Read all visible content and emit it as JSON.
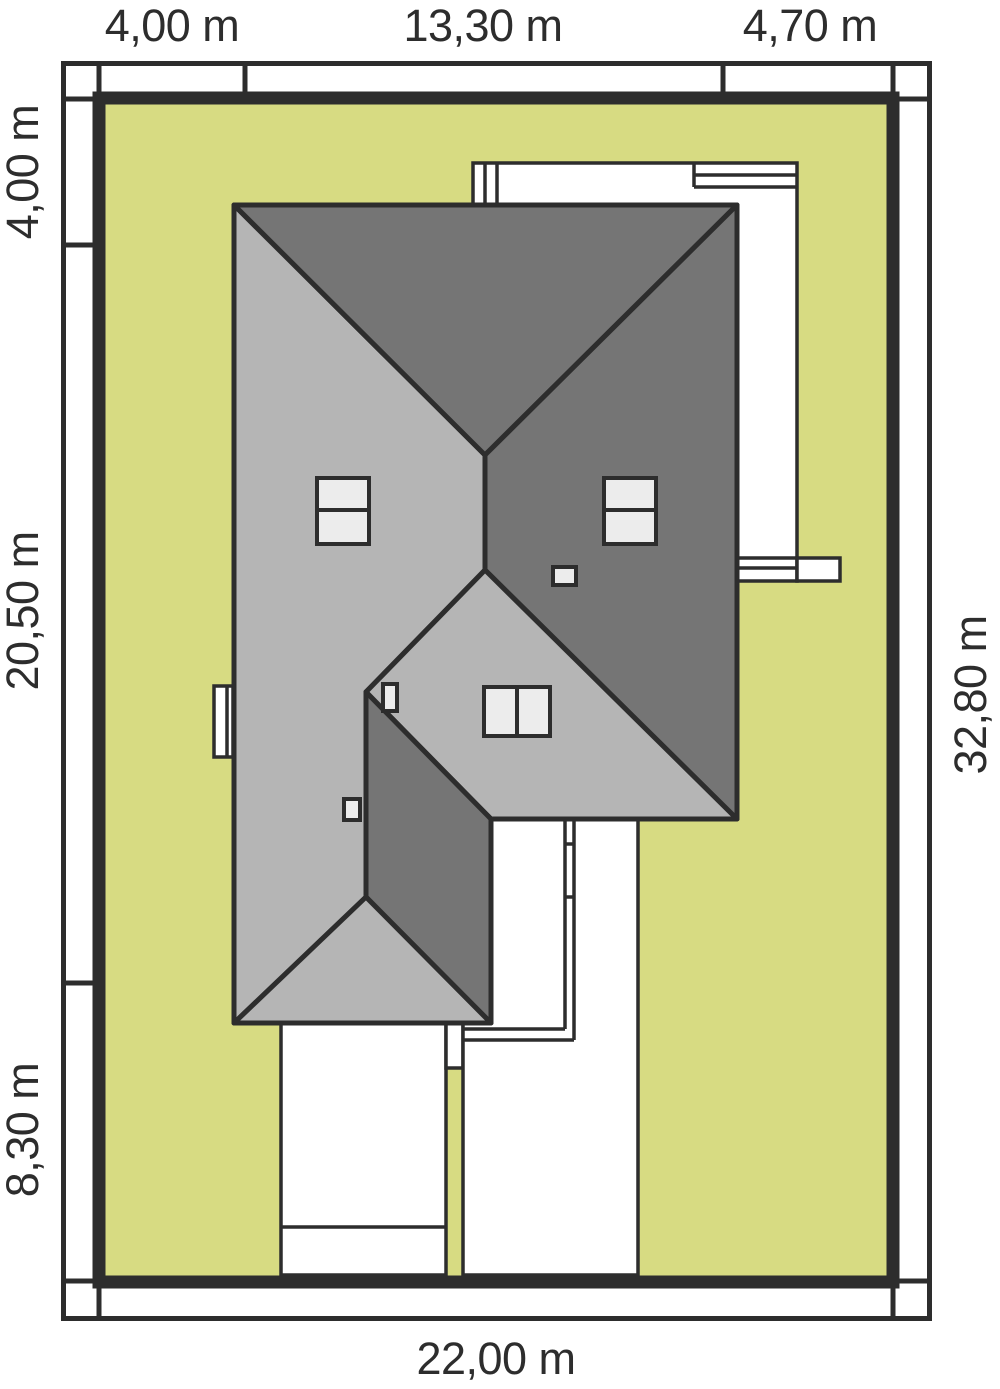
{
  "title": "House site plan",
  "colors": {
    "ink": "#2d2d2d",
    "plot_green": "#d7db82",
    "roof_light": "#b5b5b5",
    "roof_dark": "#757575",
    "roof_window": "#ececec",
    "paper": "#ffffff"
  },
  "dimensions": {
    "top": [
      "4,00 m",
      "13,30 m",
      "4,70 m"
    ],
    "left": [
      "4,00 m",
      "20,50 m",
      "8,30 m"
    ],
    "right": [
      "32,80 m"
    ],
    "bottom": [
      "22,00 m"
    ]
  }
}
